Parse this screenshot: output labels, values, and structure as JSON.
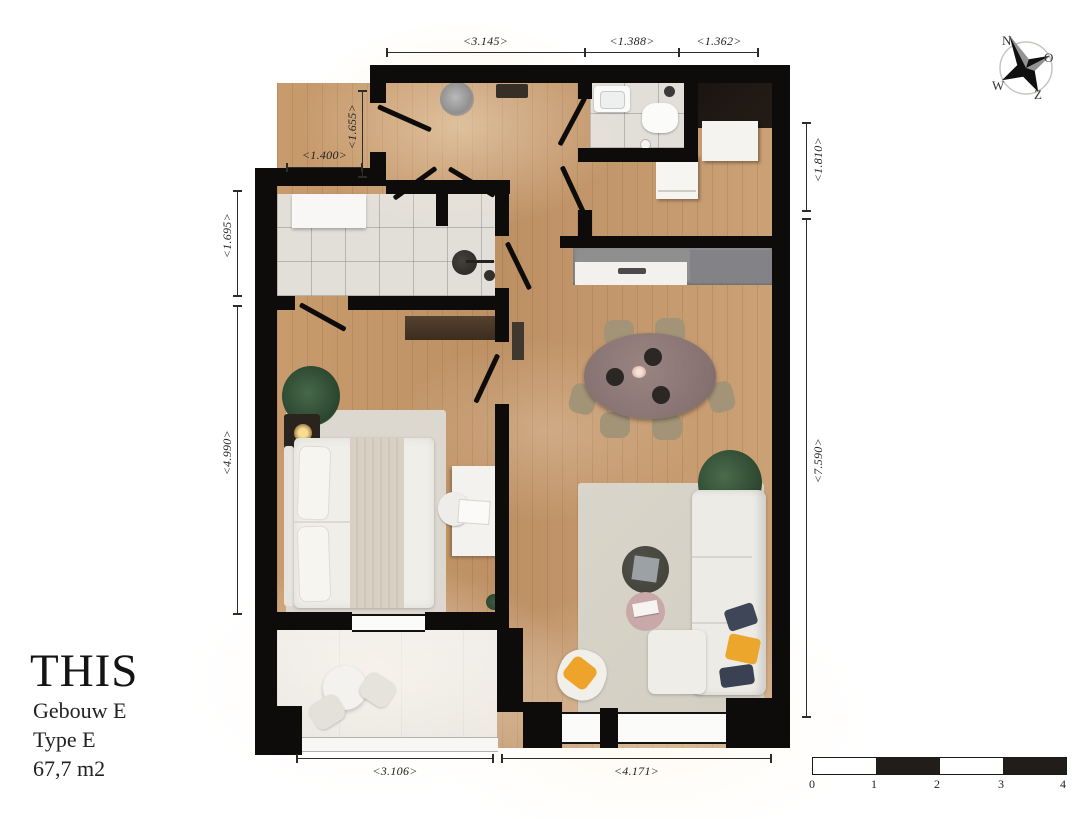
{
  "title_block": {
    "brand": "THIS",
    "building": "Gebouw E",
    "unit_type": "Type E",
    "area": "67,7 m2"
  },
  "dimensions": {
    "top": [
      "<3.145>",
      "<1.388>",
      "<1.362>"
    ],
    "left_vertical": [
      "<1.655>",
      "<1.695>",
      "<4.990>"
    ],
    "left_horizontal": [
      "<1.400>"
    ],
    "right_vertical": [
      "<1.810>",
      "<7.590>"
    ],
    "bottom": [
      "<3.106>",
      "<4.171>"
    ]
  },
  "compass": {
    "north": "N",
    "east": "O",
    "south": "Z",
    "west": "W"
  },
  "scale_bar": {
    "tick_labels": [
      "0",
      "1",
      "2",
      "3",
      "4"
    ]
  },
  "colors": {
    "wall": "#0e0c0a",
    "wood_floor": "#c89b6d",
    "tile_floor": "#e2dfd9",
    "balcony_floor": "#efede9",
    "rug": "#d6d2c7",
    "sofa": "#edebe6",
    "dining_table": "#8a7673",
    "kitchen_counter": "#8f8f90",
    "accent_yellow": "#eda62c",
    "accent_navy": "#3e4658",
    "accent_pink": "#c8a8a8"
  }
}
